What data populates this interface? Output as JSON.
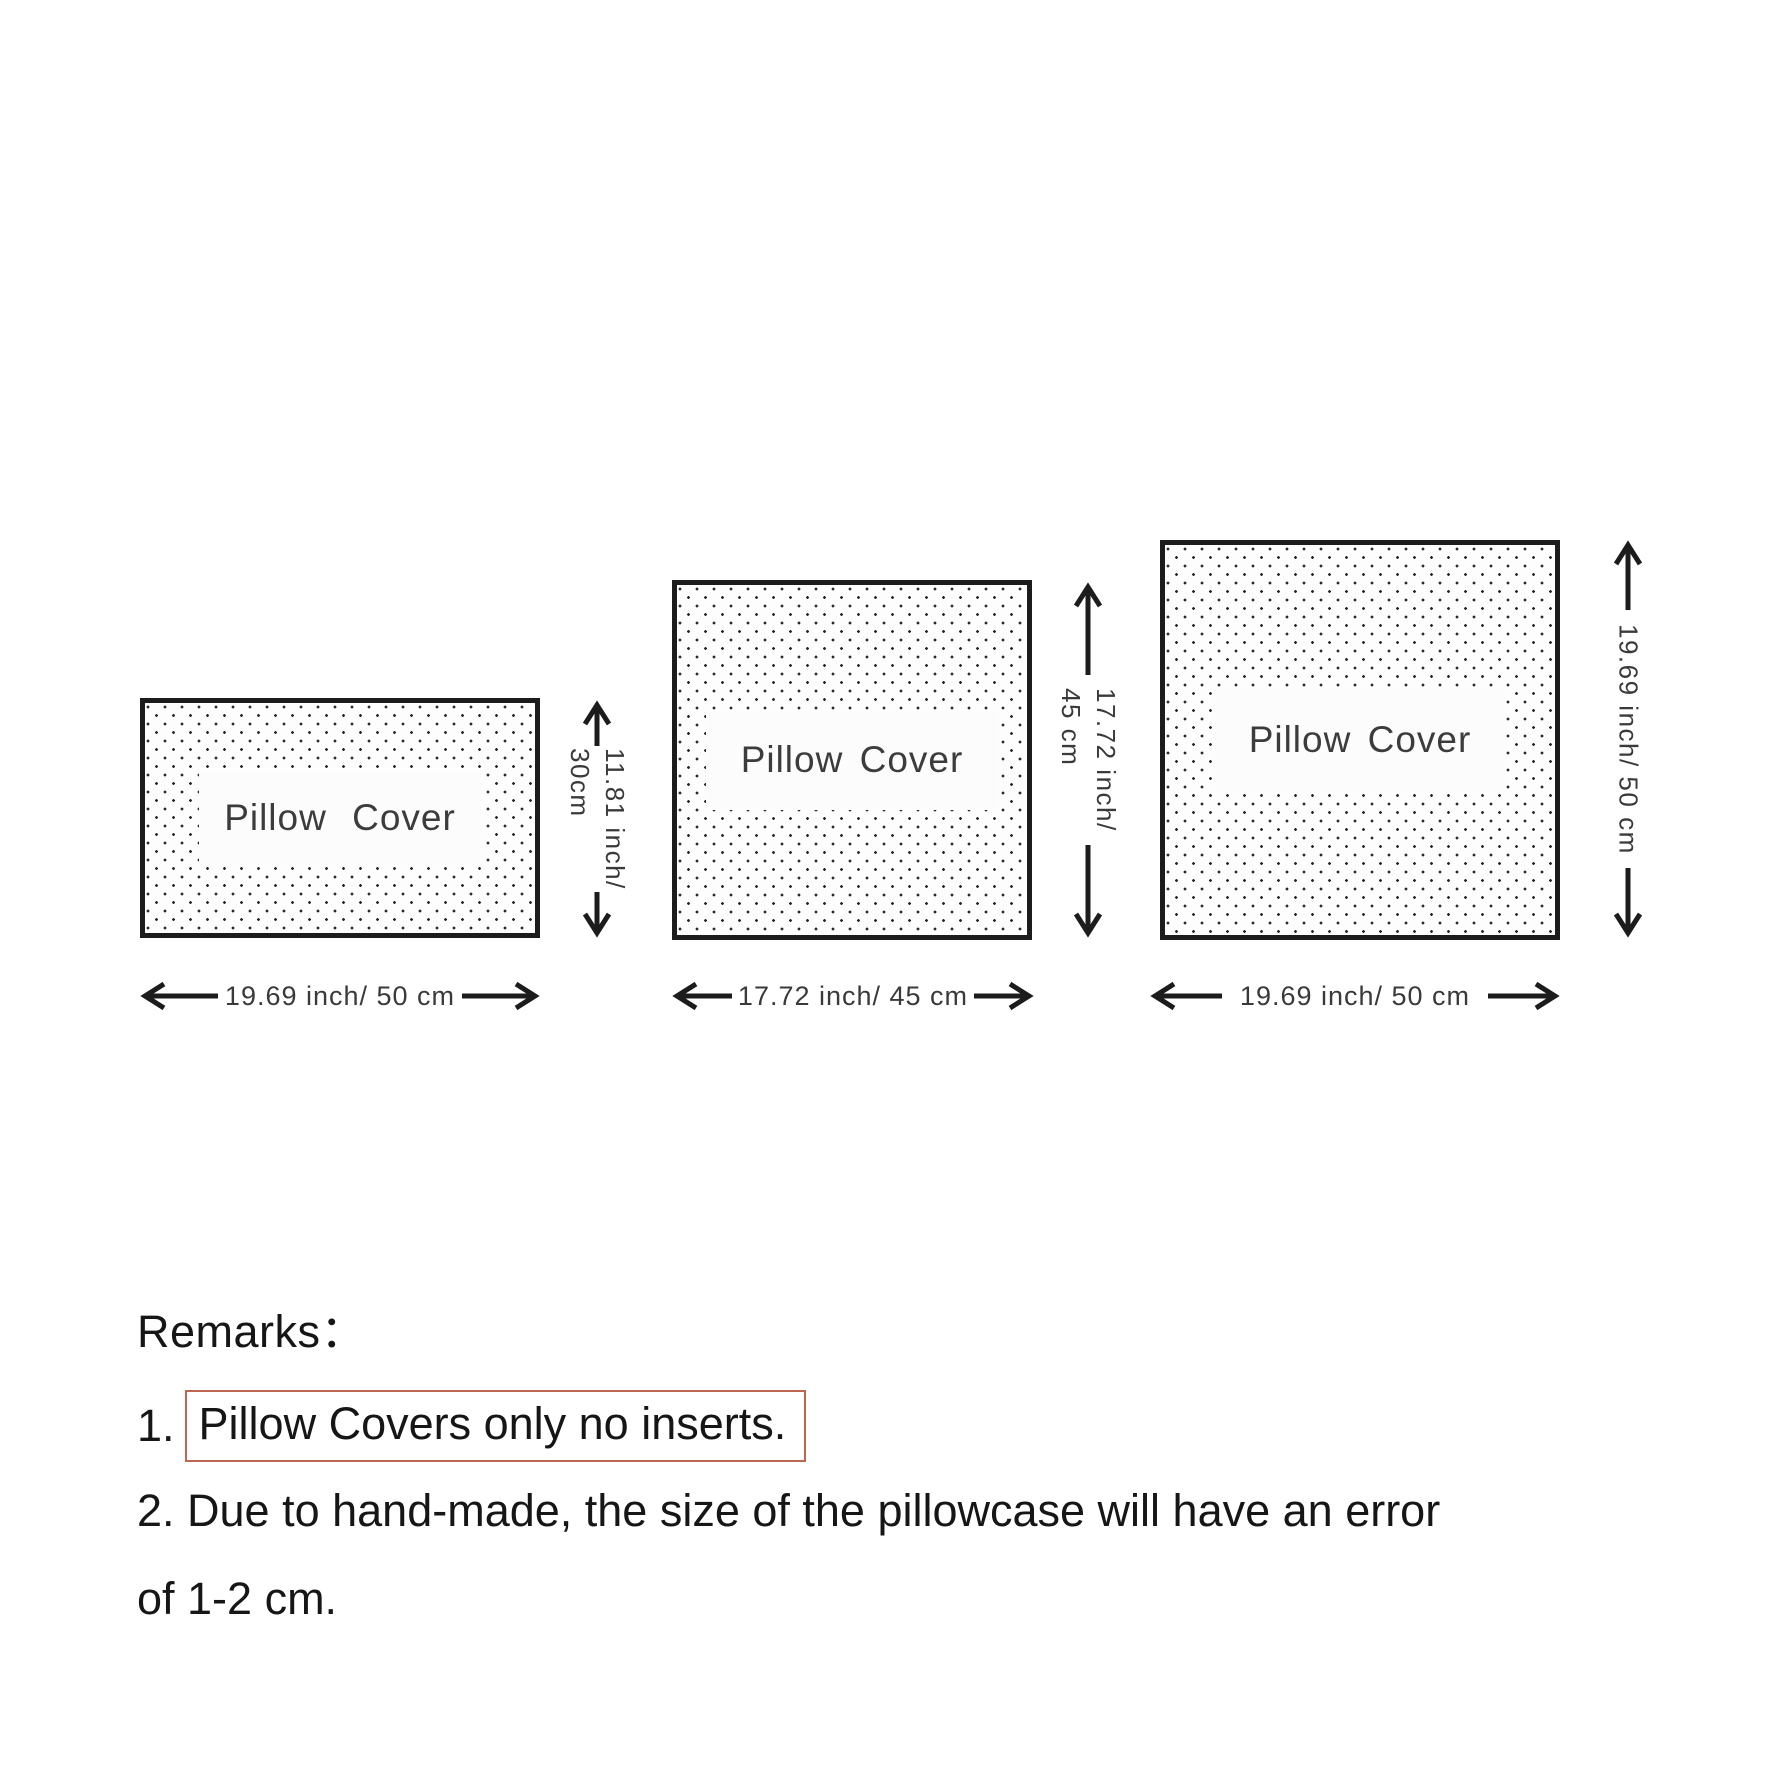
{
  "theme": {
    "ink": "#1c1c1c",
    "dim_text": "#3a3a3a",
    "box_border": "#bb6752",
    "bg": "#ffffff"
  },
  "diagram": {
    "pillows": [
      {
        "name": "pillow-cover-50x30",
        "label": "Pillow Cover",
        "width_label": "19.69 inch/ 50 cm",
        "height_label_line1": "11.81 inch/",
        "height_label_line2": "30cm"
      },
      {
        "name": "pillow-cover-45x45",
        "label": "Pillow Cover",
        "width_label": "17.72 inch/ 45 cm",
        "height_label_line1": "17.72 inch/",
        "height_label_line2": "45 cm"
      },
      {
        "name": "pillow-cover-50x50",
        "label": "Pillow Cover",
        "width_label": "19.69 inch/ 50 cm",
        "height_label_line1": "19.69 inch/ 50 cm"
      }
    ]
  },
  "remarks": {
    "title": "Remarks：",
    "item1_number": "1.",
    "item1_boxed_text": "Pillow Covers only no inserts.",
    "item2_text_line1": "2. Due to hand-made, the size of the pillowcase will have an error",
    "item2_text_line2": "of 1-2 cm."
  }
}
